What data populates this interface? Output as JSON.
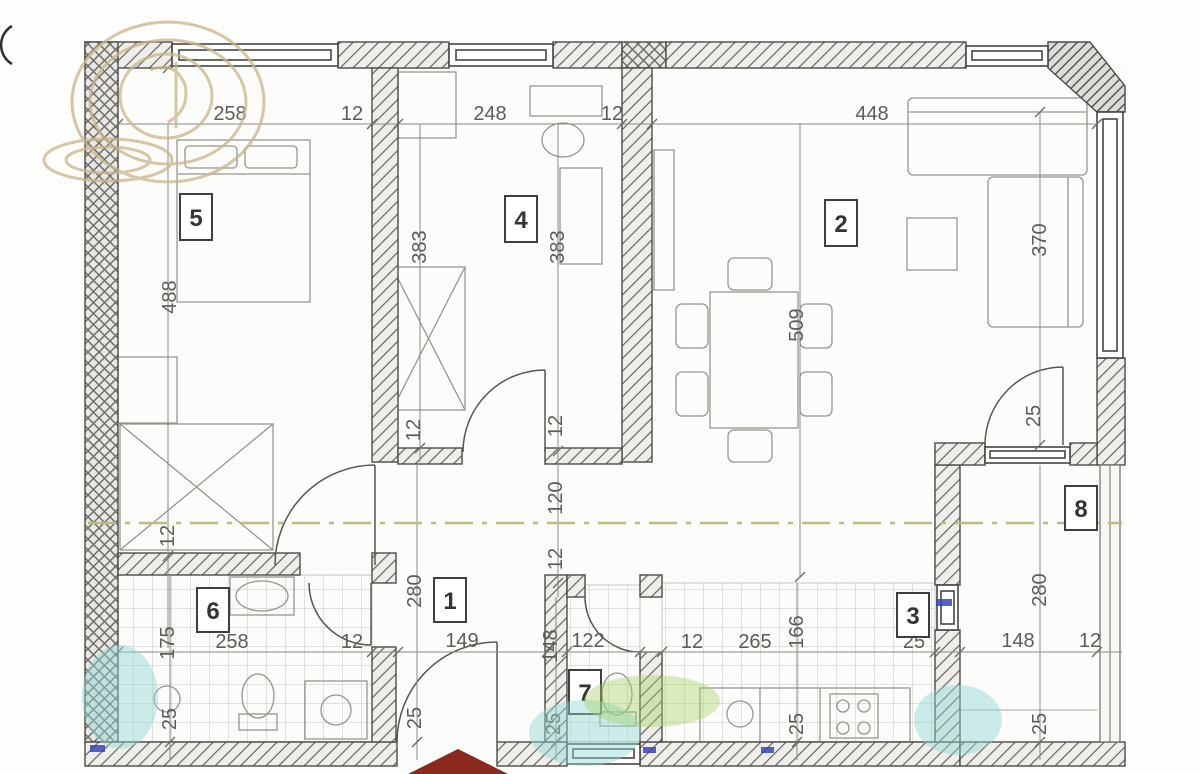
{
  "plan_title": "apartment-floor-plan",
  "rooms": [
    "5",
    "4",
    "2",
    "6",
    "1",
    "7",
    "3",
    "8"
  ],
  "dims_h": [
    "258",
    "12",
    "248",
    "12",
    "448",
    "258",
    "12",
    "149",
    "122",
    "12",
    "265",
    "25",
    "148",
    "12"
  ],
  "dims_v": [
    "488",
    "383",
    "383",
    "370",
    "509",
    "12",
    "12",
    "12",
    "120",
    "12",
    "280",
    "280",
    "175",
    "148",
    "166",
    "25",
    "25",
    "25",
    "25",
    "25",
    "25"
  ],
  "colors": {
    "wall_line": "#4c4b47",
    "hatch_fill": "#efeeea",
    "watermark_gold": "#c8b68a",
    "watermark_cyan": "#8fd8d2",
    "watermark_green": "#a5cf62",
    "marker_blue": "#3a45b8",
    "entrance_red": "#8a2a1c",
    "axis_olive": "#bdbb7e"
  }
}
